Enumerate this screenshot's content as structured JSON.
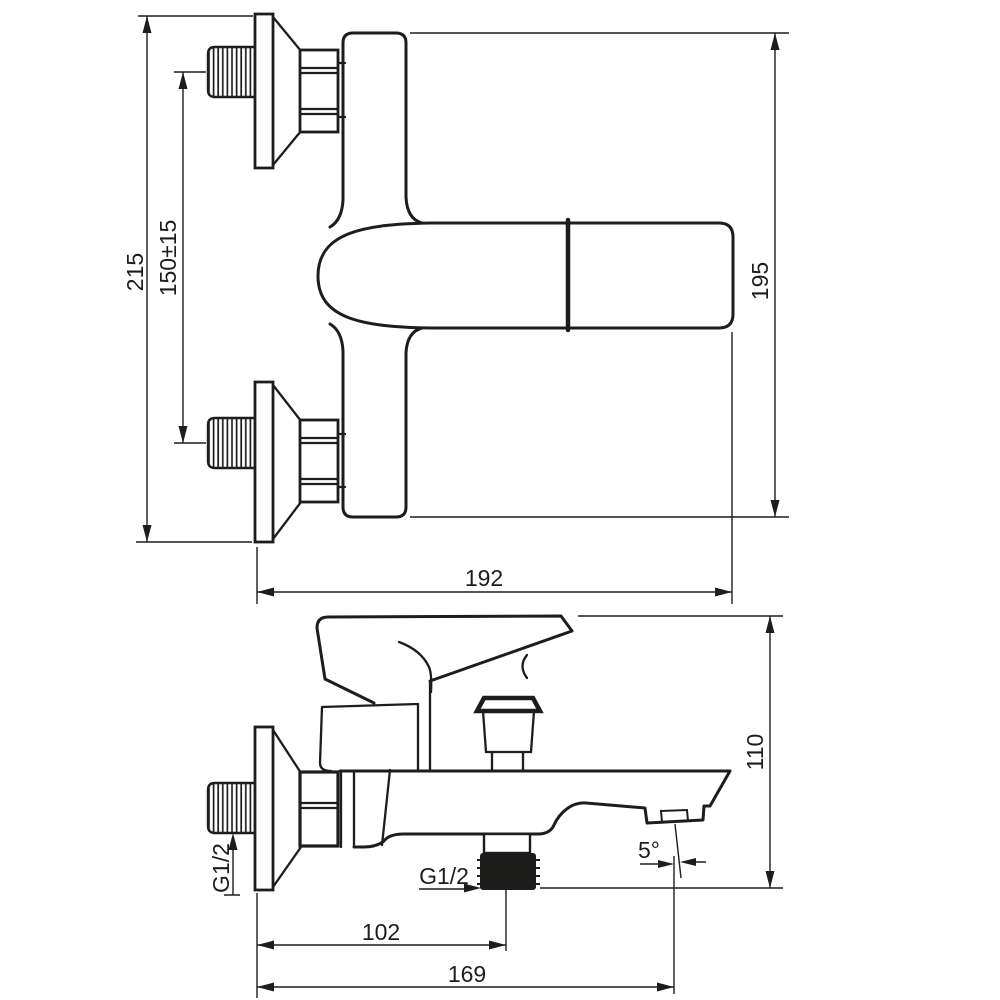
{
  "drawing": {
    "type": "technical-dimension-drawing",
    "subject": "wall-mounted bath shower mixer faucet, two orthographic views with dimensions (mm)",
    "colors": {
      "background": "#ffffff",
      "line": "#1d1d1b"
    },
    "front_view": {
      "overall_height": "215",
      "inlet_spacing": "150±15",
      "body_height": "195",
      "overall_width": "192"
    },
    "side_view": {
      "height_to_spout": "110",
      "outlet_offset": "102",
      "spout_reach": "169",
      "spout_angle": "5°",
      "inlet_thread": "G1/2",
      "outlet_thread": "G1/2"
    }
  }
}
